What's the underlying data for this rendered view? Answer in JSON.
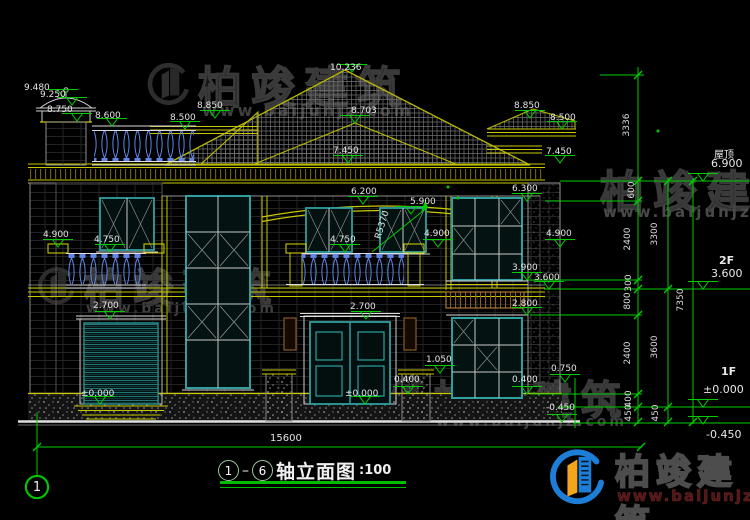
{
  "watermark": {
    "brand": "柏竣建筑",
    "url": "www.baijunjz.com"
  },
  "title": {
    "axis_start": "1",
    "axis_end": "6",
    "name": "轴立面图",
    "scale": ":100"
  },
  "bottom_dimension": "15600",
  "axis_bubble_left": "1",
  "floor_labels": {
    "roof_name": "屋顶",
    "roof_value": "6.900",
    "f2_name": "2F",
    "f2_value": "3.600",
    "f1_name": "1F",
    "f1_value": "±0.000",
    "ground_value": "-0.450"
  },
  "vertical_dims": [
    "3336",
    "600",
    "2400",
    "300",
    "800",
    "2400",
    "400",
    "450",
    "3300",
    "3600",
    "450",
    "7350"
  ],
  "elevations": [
    "9.480",
    "9.250",
    "8.750",
    "8.600",
    "8.500",
    "8.850",
    "10.236",
    "8.703",
    "7.450",
    "8.850",
    "8.500",
    "7.450",
    "6.200",
    "5.900",
    "R5370",
    "4.900",
    "4.750",
    "4.750",
    "4.900",
    "6.300",
    "4.900",
    "3.900",
    "3.600",
    "2.800",
    "2.700",
    "2.700",
    "1.050",
    "0.400",
    "±0.000",
    "±0.000",
    "0.400",
    "0.750",
    "-0.450"
  ]
}
